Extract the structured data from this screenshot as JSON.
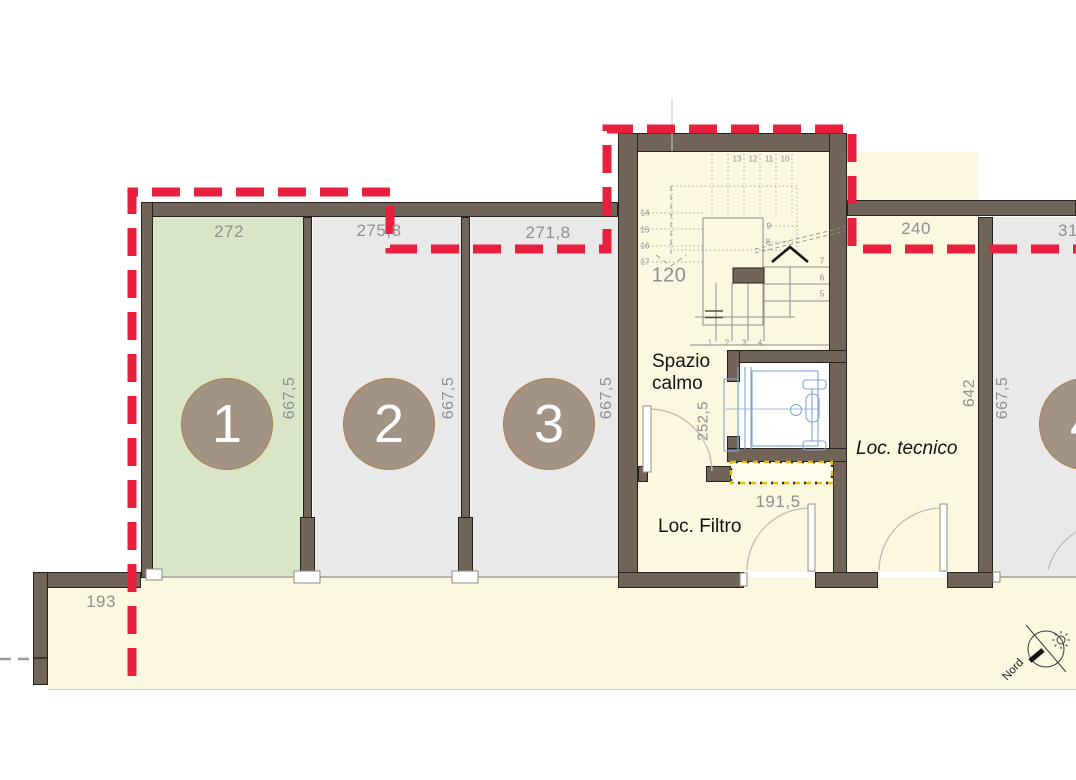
{
  "stalls": [
    {
      "number": "1",
      "width": "272",
      "depth": "667,5"
    },
    {
      "number": "2",
      "width": "275,8",
      "depth": "667,5"
    },
    {
      "number": "3",
      "width": "271,8",
      "depth": "667,5"
    },
    {
      "number": "4",
      "width": "31",
      "depth": "667,5"
    }
  ],
  "rooms": {
    "spazio_calmo": {
      "line1": "Spazio",
      "line2": "calmo",
      "door_width": "252,5"
    },
    "loc_filtro": {
      "label": "Loc. Filtro",
      "pit_width": "191,5"
    },
    "loc_tecnico": {
      "label": "Loc. tecnico",
      "width": "240",
      "depth": "642"
    }
  },
  "stairs": {
    "width_label": "120",
    "steps": [
      "1",
      "2",
      "3",
      "4",
      "5",
      "6",
      "7",
      "8",
      "9",
      "10",
      "11",
      "12",
      "13",
      "14",
      "15",
      "16",
      "17"
    ]
  },
  "site": {
    "entry_width": "193"
  },
  "compass": {
    "label": "Nord"
  },
  "colors": {
    "boundary_red": "#e8203e",
    "stall_green": "#d8e5c7",
    "stall_gray": "#e9e9e9",
    "floor_cream": "#fcf7df",
    "wall_brown": "#71655a",
    "circle_fill": "#a29384",
    "elevator_blue": "#7fa6d6",
    "strip_yellow": "#e7bb09"
  }
}
